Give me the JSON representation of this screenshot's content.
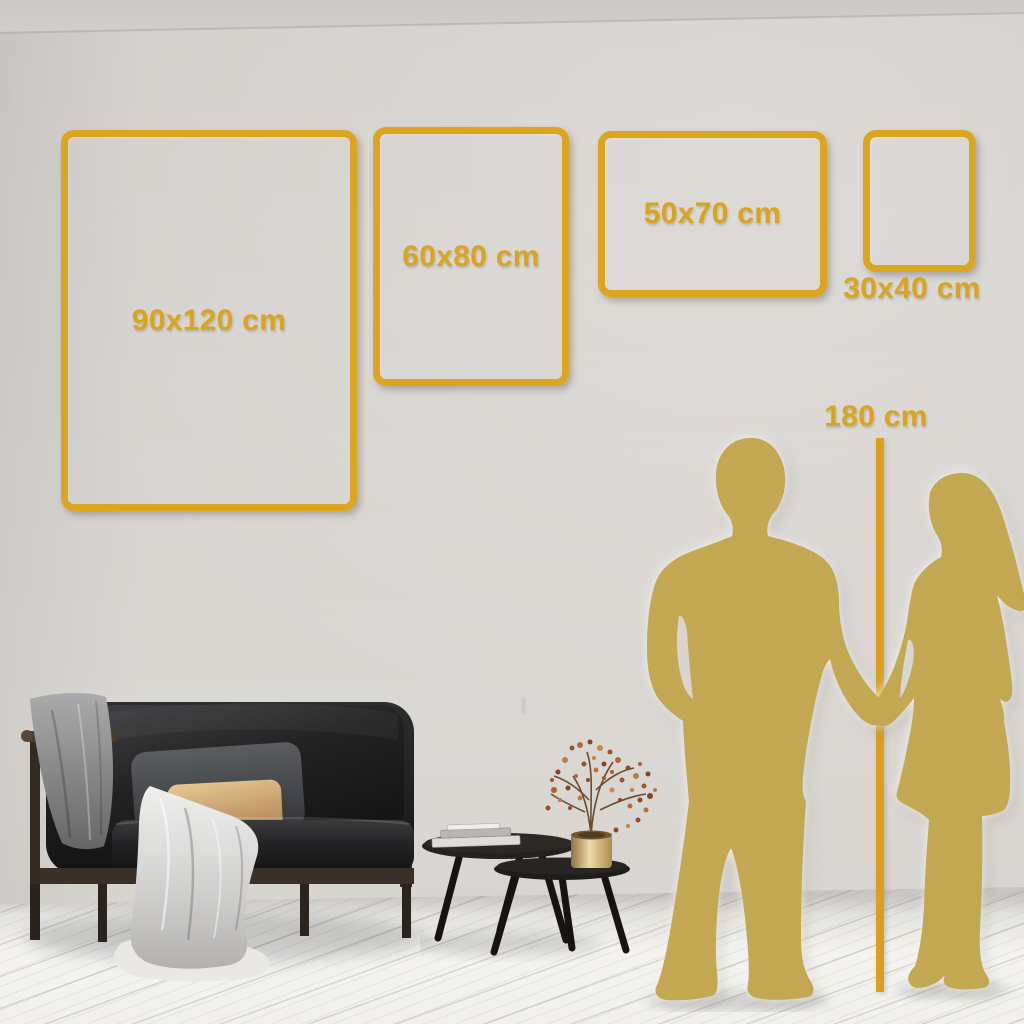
{
  "page": {
    "type": "poster-size-comparison-visual",
    "description": "Wall-size guide showing four gold frame outlines with dimension labels, a 180 cm height reference line, couple silhouettes, sofa and coffee tables"
  },
  "size_frames": [
    {
      "id": "90x120",
      "label": "90x120 cm",
      "width_cm": 90,
      "height_cm": 120,
      "orientation": "portrait",
      "label_placement": "inside"
    },
    {
      "id": "60x80",
      "label": "60x80 cm",
      "width_cm": 60,
      "height_cm": 80,
      "orientation": "portrait",
      "label_placement": "inside"
    },
    {
      "id": "50x70",
      "label": "50x70 cm",
      "width_cm": 50,
      "height_cm": 70,
      "orientation": "landscape",
      "label_placement": "inside"
    },
    {
      "id": "30x40",
      "label": "30x40 cm",
      "width_cm": 30,
      "height_cm": 40,
      "orientation": "portrait",
      "label_placement": "below"
    }
  ],
  "height_reference": {
    "label": "180 cm",
    "value_cm": 180
  },
  "colors": {
    "accent_gold": "#DCA51F",
    "text_gold": "#D9A41E",
    "silhouette_gold": "#C2A851",
    "wall": "#D6D3CF",
    "floor": "#F2F1EF"
  },
  "figures": {
    "people": [
      "man-silhouette",
      "woman-silhouette"
    ],
    "furniture": [
      "sofa",
      "gray-blanket",
      "white-throw-blanket",
      "gray-pillow",
      "beige-pillow",
      "coffee-table-large",
      "coffee-table-small",
      "books-stack",
      "gold-vase",
      "dried-flower-branches"
    ]
  }
}
